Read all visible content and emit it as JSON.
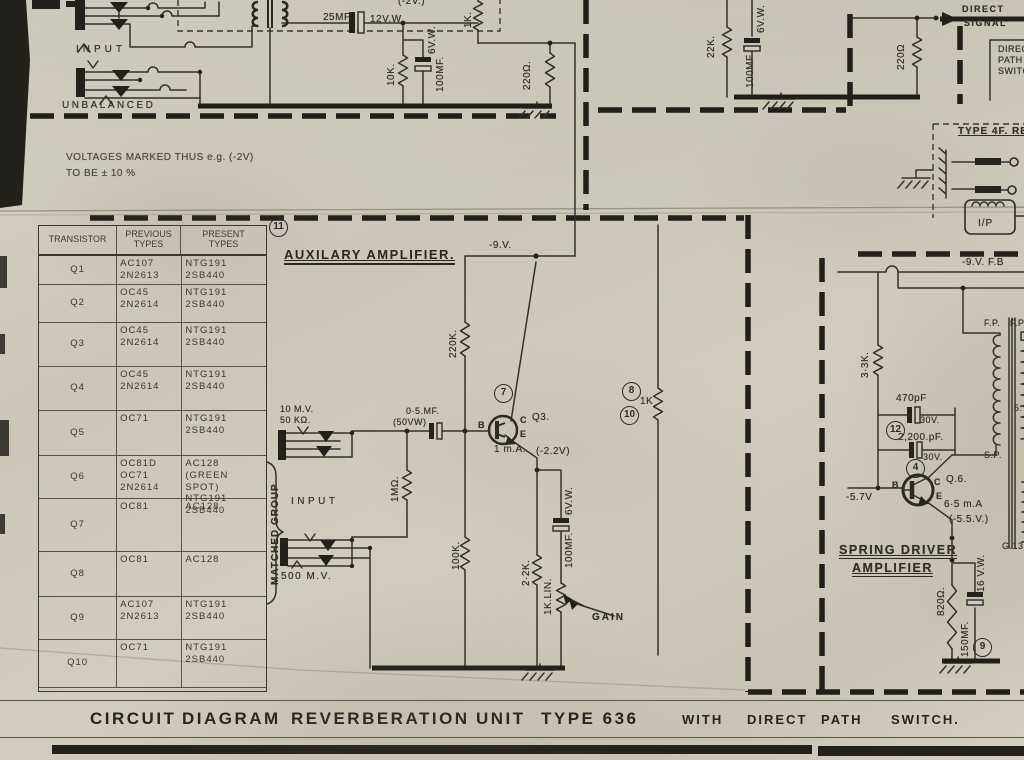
{
  "note": {
    "line1": "VOLTAGES MARKED THUS e.g. (-2V)",
    "line2": "TO BE ± 10 %"
  },
  "table": {
    "headers": [
      "TRANSISTOR",
      "PREVIOUS\nTYPES",
      "PRESENT\nTYPES"
    ],
    "circled_ref": "11",
    "matched_group": "MATCHED GROUP",
    "rows": [
      {
        "q": "Q1",
        "previous": "AC107\n2N2613",
        "present": "NTG191\n2SB440"
      },
      {
        "q": "Q2",
        "previous": "OC45\n2N2614",
        "present": "NTG191\n2SB440"
      },
      {
        "q": "Q3",
        "previous": "OC45\n2N2614",
        "present": "NTG191\n2SB440"
      },
      {
        "q": "Q4",
        "previous": "OC45\n2N2614",
        "present": "NTG191\n2SB440"
      },
      {
        "q": "Q5",
        "previous": "OC71",
        "present": "NTG191\n2SB440"
      },
      {
        "q": "Q6",
        "previous": "OC81D\nOC71\n2N2614",
        "present": "AC128\n(GREEN SPOT)\nNTG191\n2SB440"
      },
      {
        "q": "Q7",
        "previous": "OC81",
        "present": "AC128"
      },
      {
        "q": "Q8",
        "previous": "OC81",
        "present": "AC128"
      },
      {
        "q": "Q9",
        "previous": "AC107\n2N2613",
        "present": "NTG191\n2SB440"
      },
      {
        "q": "Q10",
        "previous": "OC71",
        "present": "NTG191\n2SB440"
      }
    ]
  },
  "topleft": {
    "input": "INPUT",
    "unbalanced": "UNBALANCED"
  },
  "topmid": {
    "c25": "25MF.",
    "v12": "12V.W.",
    "v2": "(-2V.)",
    "r1k": "1K.",
    "r10k": "10K.",
    "c100v": "6V.W.",
    "c100": "100MF.",
    "r220": "220Ω."
  },
  "righttop": {
    "r22k": "22K.",
    "c100v": "6V.W.",
    "c100": "100MF",
    "r220": "220Ω",
    "direct1": "DIRECT",
    "direct2": "SIGNAL",
    "dps": "DIRECT\nPATH\nSWITCH"
  },
  "type4f": {
    "title": "TYPE 4F. RE",
    "ip": "I/P"
  },
  "aux": {
    "heading": "AUXILARY AMPLIFIER.",
    "neg9": "-9.V.",
    "r220k": "220K.",
    "n7": "7",
    "q3": "Q3.",
    "b": "B",
    "c": "C",
    "e": "E",
    "ma": "1 m.A.",
    "v22": "(-2.2V)",
    "c05": "0·5.MF.",
    "c05v": "(50VW)",
    "mv10": "10 M.V.",
    "k50": "50 KΩ.",
    "input": "INPUT",
    "mv500": "500 M.V.",
    "r1m": "1MΩ.",
    "r100k": "100K.",
    "r2k2": "2·2K.",
    "c100": "100MF.",
    "c100v": "6V.W.",
    "pot": "1K.LIN.",
    "gain": "GAIN",
    "n8": "8",
    "r1k": "1K",
    "n10": "10"
  },
  "spring": {
    "fb": "-9.V. F.B",
    "r33k": "3·3K.",
    "c470": "470pF",
    "v30a": "30V.",
    "n12": "12",
    "c2200": "2,200.pF.",
    "v30b": "30V.",
    "n4": "4",
    "q6": "Q.6.",
    "b": "B",
    "c": "C",
    "e": "E",
    "v57": "-5.7V",
    "ma": "6·5 m.A",
    "v55": "(-5.5.V.)",
    "h1": "SPRING DRIVER",
    "h2": "AMPLIFIER",
    "fp1": "F.P.",
    "fp2": "F.P",
    "sp": "S.P.",
    "ratio": "5:",
    "g13": "G.13",
    "r820": "820Ω.",
    "c150": "150MF.",
    "v16": "16 V.W.",
    "n9": "9"
  },
  "title": {
    "main": [
      "CIRCUIT",
      "DIAGRAM",
      "REVERBERATION",
      "UNIT",
      "TYPE 636"
    ],
    "sub": [
      "WITH",
      "DIRECT",
      "PATH",
      "SWITCH."
    ]
  }
}
